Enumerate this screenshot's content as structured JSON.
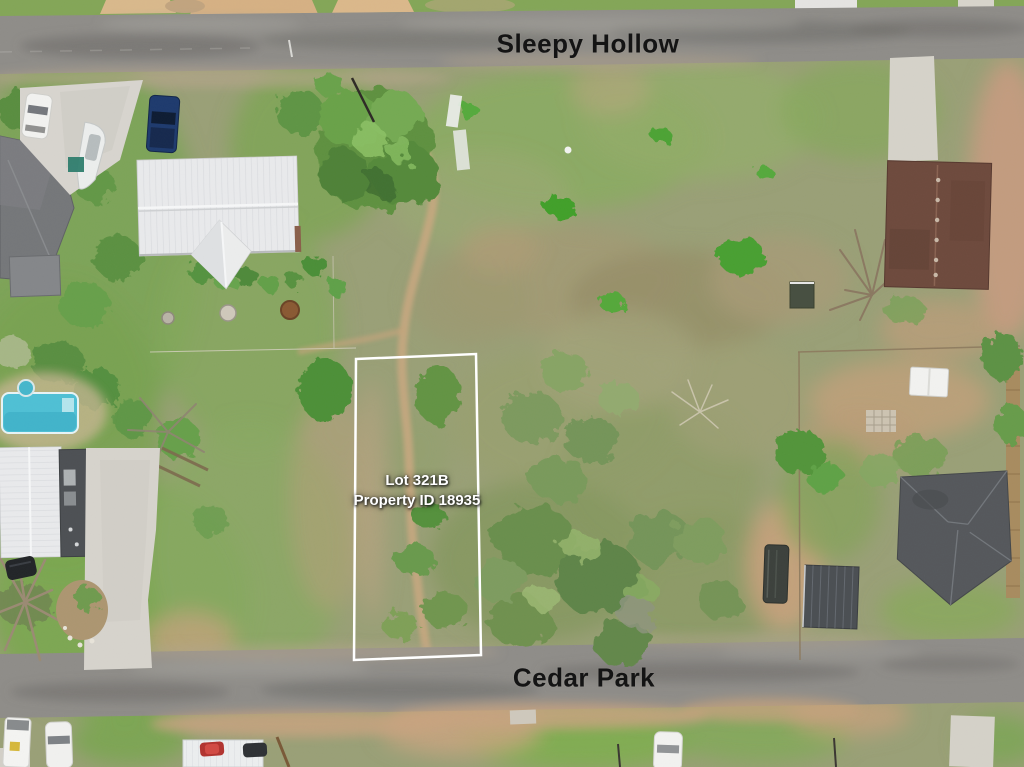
{
  "streets": {
    "top_label": "Sleepy Hollow",
    "bottom_label": "Cedar Park"
  },
  "lot": {
    "title": "Lot 321B",
    "property_id": "Property ID 18935",
    "border_color": "#ffffff"
  },
  "colors": {
    "road_asphalt": "#8f8d89",
    "road_marking": "#e8e8e4",
    "grass_green": "#7da455",
    "scrub_olive": "#99a071",
    "dirt_tan": "#c9a47f",
    "metal_roof_white": "#e9eaec",
    "house_roof_gray": "#75777a",
    "house_roof_brown": "#6e4a3d",
    "house_roof_charcoal": "#55585c",
    "shed_metal_gray": "#4b4f53",
    "pool_blue": "#4fc0d5",
    "street_label_text": "#141414",
    "lot_label_text": "#ffffff"
  }
}
